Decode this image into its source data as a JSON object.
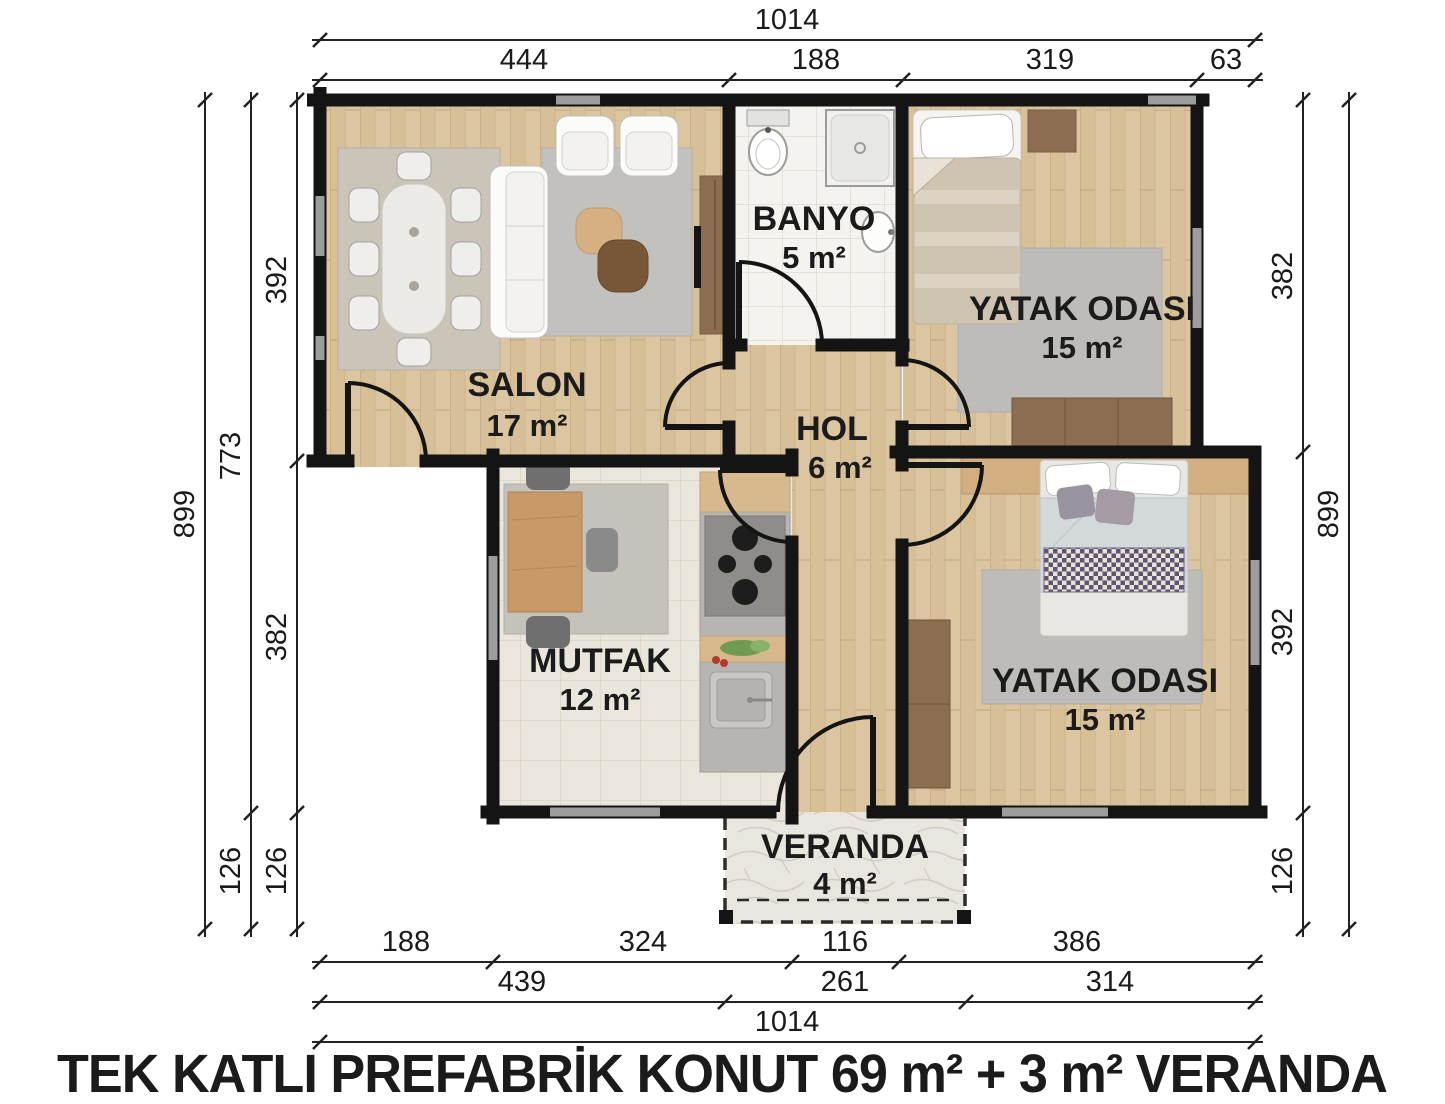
{
  "title": "TEK KATLI PREFABRİK KONUT 69 m² + 3 m² VERANDA",
  "rooms": {
    "salon": {
      "name": "SALON",
      "area": "17 m²"
    },
    "banyo": {
      "name": "BANYO",
      "area": "5 m²"
    },
    "yatak1": {
      "name": "YATAK ODASI",
      "area": "15 m²"
    },
    "hol": {
      "name": "HOL",
      "area": "6 m²"
    },
    "mutfak": {
      "name": "MUTFAK",
      "area": "12 m²"
    },
    "yatak2": {
      "name": "YATAK ODASI",
      "area": "15 m²"
    },
    "veranda": {
      "name": "VERANDA",
      "area": "4 m²"
    }
  },
  "dims": {
    "top": {
      "overall": "1014",
      "segs": [
        "444",
        "188",
        "319",
        "63"
      ]
    },
    "left": {
      "overall": "899",
      "mid": [
        "773",
        "126"
      ],
      "inner": [
        "392",
        "382",
        "126"
      ]
    },
    "right": {
      "inner": [
        "382",
        "392",
        "126"
      ],
      "overall": "899"
    },
    "bottom": {
      "row1": [
        "188",
        "324",
        "116",
        "386"
      ],
      "row2": [
        "439",
        "261",
        "314"
      ],
      "overall": "1014"
    }
  },
  "colors": {
    "wall": "#141414",
    "wood_floor": "#dcc6a1",
    "tile_bath": "#f4f3f0",
    "tile_kitchen": "#eae6dc",
    "stone_veranda": "#e9e6e0",
    "rug_gray": "#bdbcb8",
    "dark_wood": "#8d6d52",
    "window_gray": "#9d9d9d"
  }
}
